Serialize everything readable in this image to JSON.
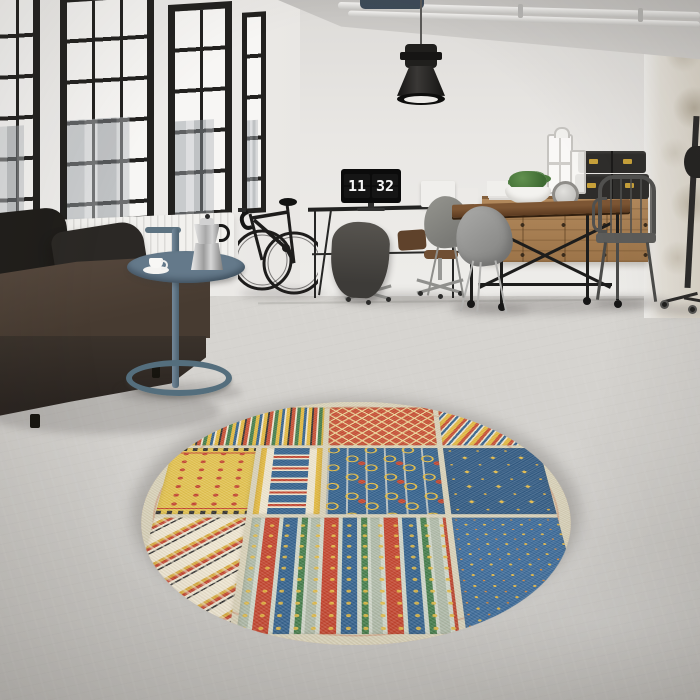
{
  "scene": {
    "description": "Industrial loft interior photo with round patchwork rug",
    "clock": {
      "hours": "11",
      "minutes": "32"
    }
  },
  "colors": {
    "wall": "#e6e4e1",
    "window_frame": "#22211f",
    "duct": "#3d4a58",
    "radiator": "#f2f1ee",
    "sofa_dark": "#3a322b",
    "sofa_mid": "#584a3f",
    "cushion": "#1f1d1a",
    "table_blue": "#5d7381",
    "lamp": "#201f1d",
    "wood_sideboard": "#b2895c",
    "wood_table_light": "#7d5634",
    "wood_table_dark": "#5b3a20",
    "box_black": "#2e2d2b",
    "brass": "#c9a23a",
    "rug_cream": "#d8d1b8",
    "rug_red": "#c64b2f",
    "rug_blue": "#2e5e8c",
    "rug_yellow": "#e3b93d",
    "rug_green": "#3f7a48"
  },
  "rug": {
    "shape": "round",
    "panels": [
      "multicolor-vertical-stripes",
      "red-diamond-lattice",
      "diagonal-waves",
      "yellow-red-dots",
      "blue-red-ornament",
      "blue-yellow-swirls",
      "blue-large-stars",
      "aztec-zigzag",
      "scroll-stripe-columns",
      "blue-small-stars"
    ]
  }
}
